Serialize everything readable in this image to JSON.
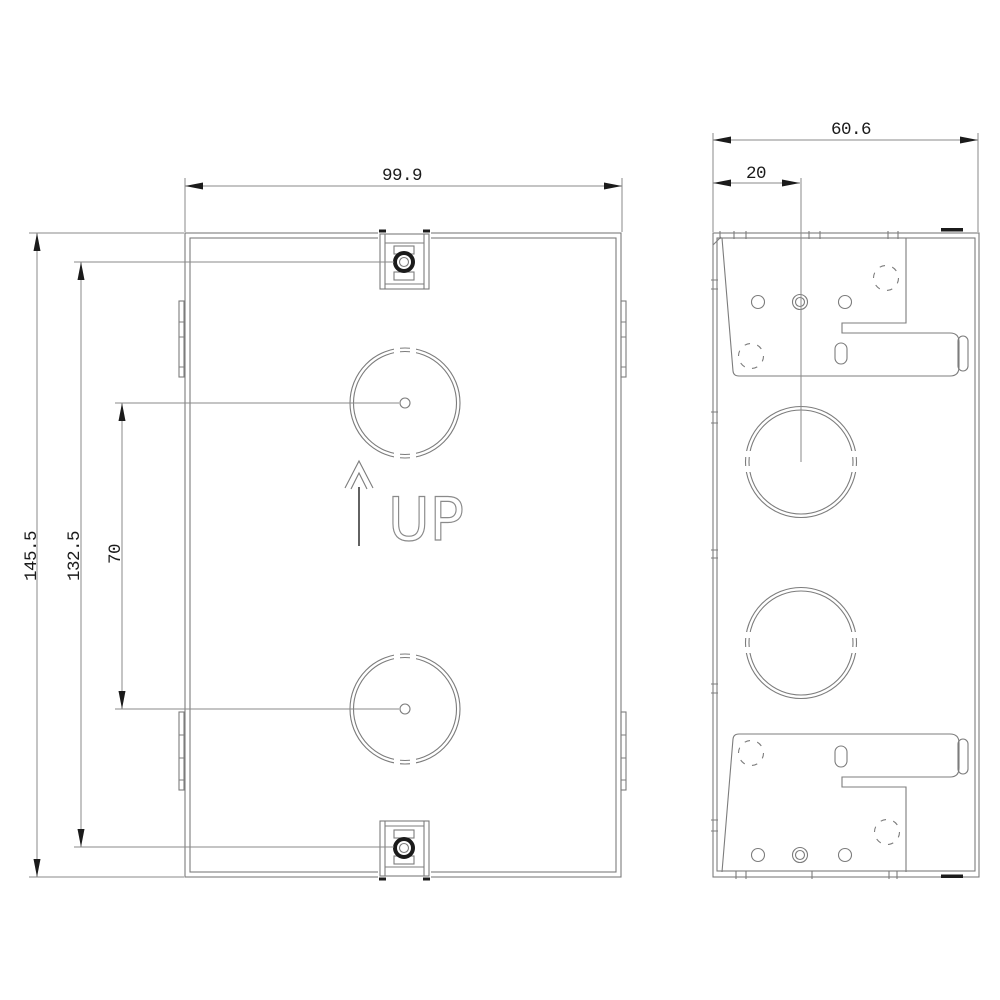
{
  "front_view": {
    "dimensions": {
      "width": "99.9",
      "height": "145.5",
      "clamp_screw_spacing": "132.5",
      "knockout_spacing": "70"
    },
    "up_marking": "UP"
  },
  "side_view": {
    "dimensions": {
      "depth": "60.6",
      "knockout_center_offset": "20"
    }
  },
  "colors": {
    "background": "#ffffff",
    "line_gray": "#7c7c7c",
    "dim_gray": "#8a8a8a",
    "ink_black": "#1b1b1b"
  }
}
